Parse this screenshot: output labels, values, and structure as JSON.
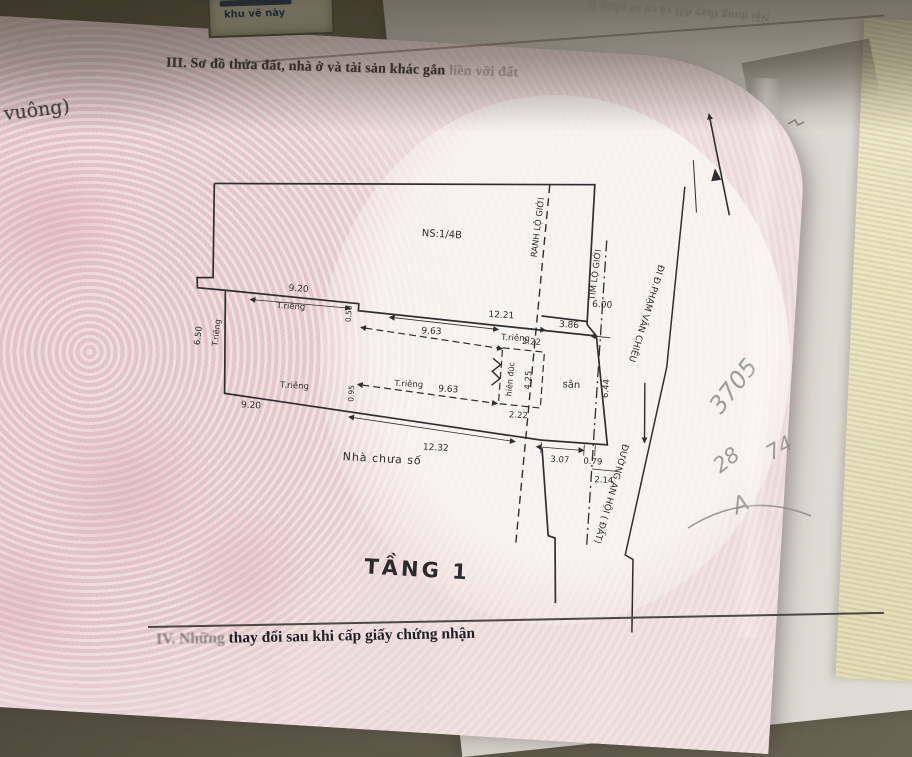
{
  "photo": {
    "section_heading": "III. Sơ đồ thửa đất, nhà ở và tài sản khác gắn",
    "section_heading_faded": "liền với đất",
    "back_page_text": "Nội dung thay đổi và cơ sở pháp lý",
    "corner_box_line": "khu vẽ này",
    "left_margin_fragment": "t vuông)",
    "bottom_heading_prefix": "IV. Những",
    "bottom_heading_rest": " thay đổi sau khi cấp giấy chứng nhận",
    "handwriting": {
      "h1": "3705",
      "h2": "28",
      "h3": "74",
      "h4": "A"
    }
  },
  "plan": {
    "labels": {
      "parcel": "NS:1/4B",
      "floor": "TẦNG 1",
      "house": "Nhà chưa số",
      "yard": "sân",
      "porch": "hiên đúc",
      "private": "T.riêng",
      "road_boundary": "RANH LỘ GIỚI",
      "road_center": "TIM LỘ GIỚI",
      "direction": "ĐI Đ.PHẠM VĂN CHIÊU",
      "road_name": "ĐƯỜNG AN HỘI ( ĐẤT)"
    },
    "dims": {
      "d920": "9.20",
      "d1221": "12.21",
      "d963": "9.63",
      "d386": "3.86",
      "d600": "6.00",
      "d650": "6.50",
      "d050": "0.50",
      "d095": "0.95",
      "d222": "2.22",
      "d425": "4.25",
      "d644": "6.44",
      "d1232": "12.32",
      "d307": "3.07",
      "d079": "0.79",
      "d214": "2.14"
    }
  },
  "colors": {
    "certificate_pink": "#e6ccd0",
    "back_paper": "#d8d5ce",
    "wall_yellow": "#e7e1bb",
    "drawing_ink": "#2e2e30",
    "desk_olive": "#57534a"
  }
}
